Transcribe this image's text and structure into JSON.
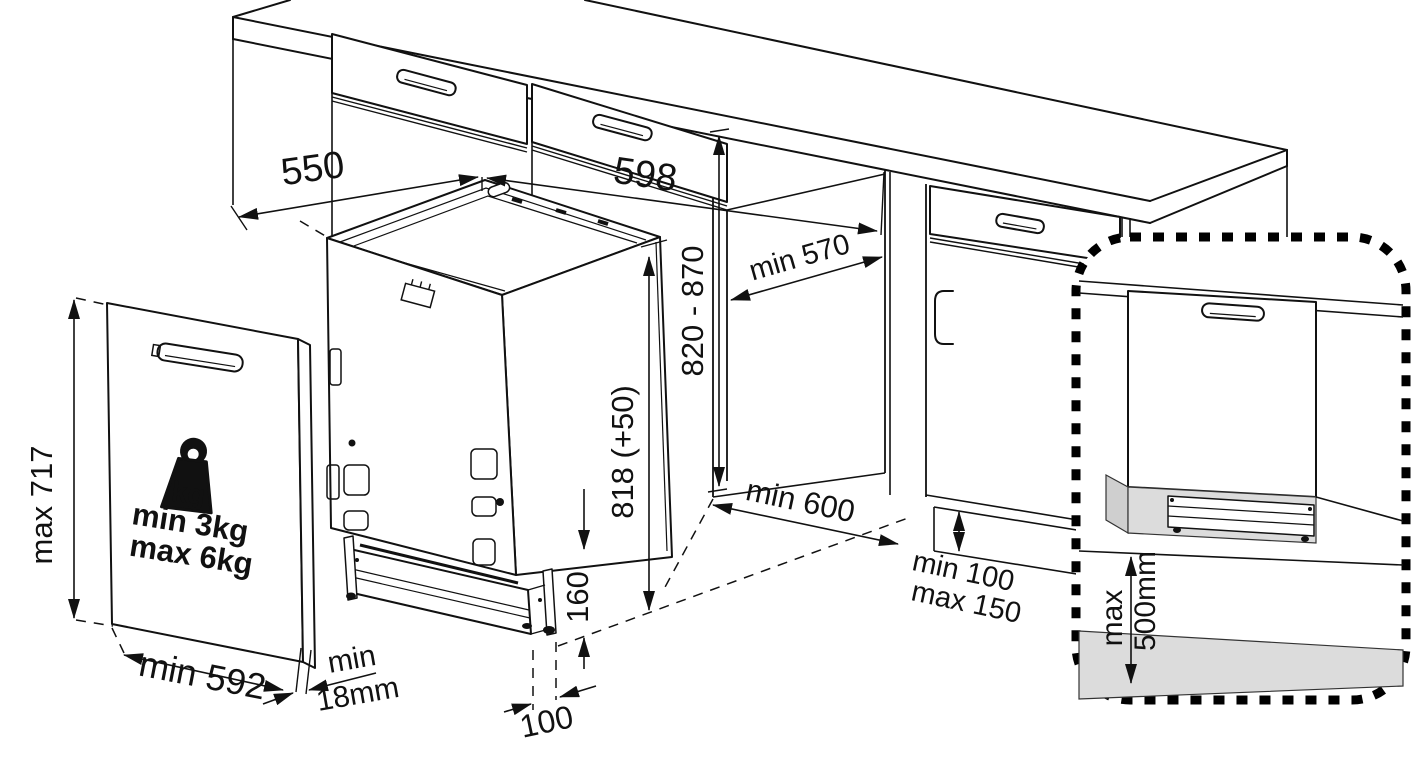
{
  "diagram": {
    "kind": "built-in dishwasher installation drawing",
    "dimensions": {
      "top_depth": "550",
      "niche_width": "598",
      "worktop_height_range": "820 - 870",
      "niche_depth": "min 570",
      "appliance_height": "818 (+50)",
      "base_height": "160",
      "foot_inset": "100",
      "front_clearance": "min 600",
      "plinth_gap_min": "min 100",
      "plinth_gap_max": "max 150",
      "door_panel_height": "max 717",
      "door_panel_width": "min 592",
      "door_panel_thickness_label": "min",
      "door_panel_thickness_value": "18mm",
      "door_weight_min": "min  3kg",
      "door_weight_max": "max 6kg",
      "weight_unit": "kg",
      "plinth_detail_label": "max",
      "plinth_detail_value": "500mm"
    }
  }
}
